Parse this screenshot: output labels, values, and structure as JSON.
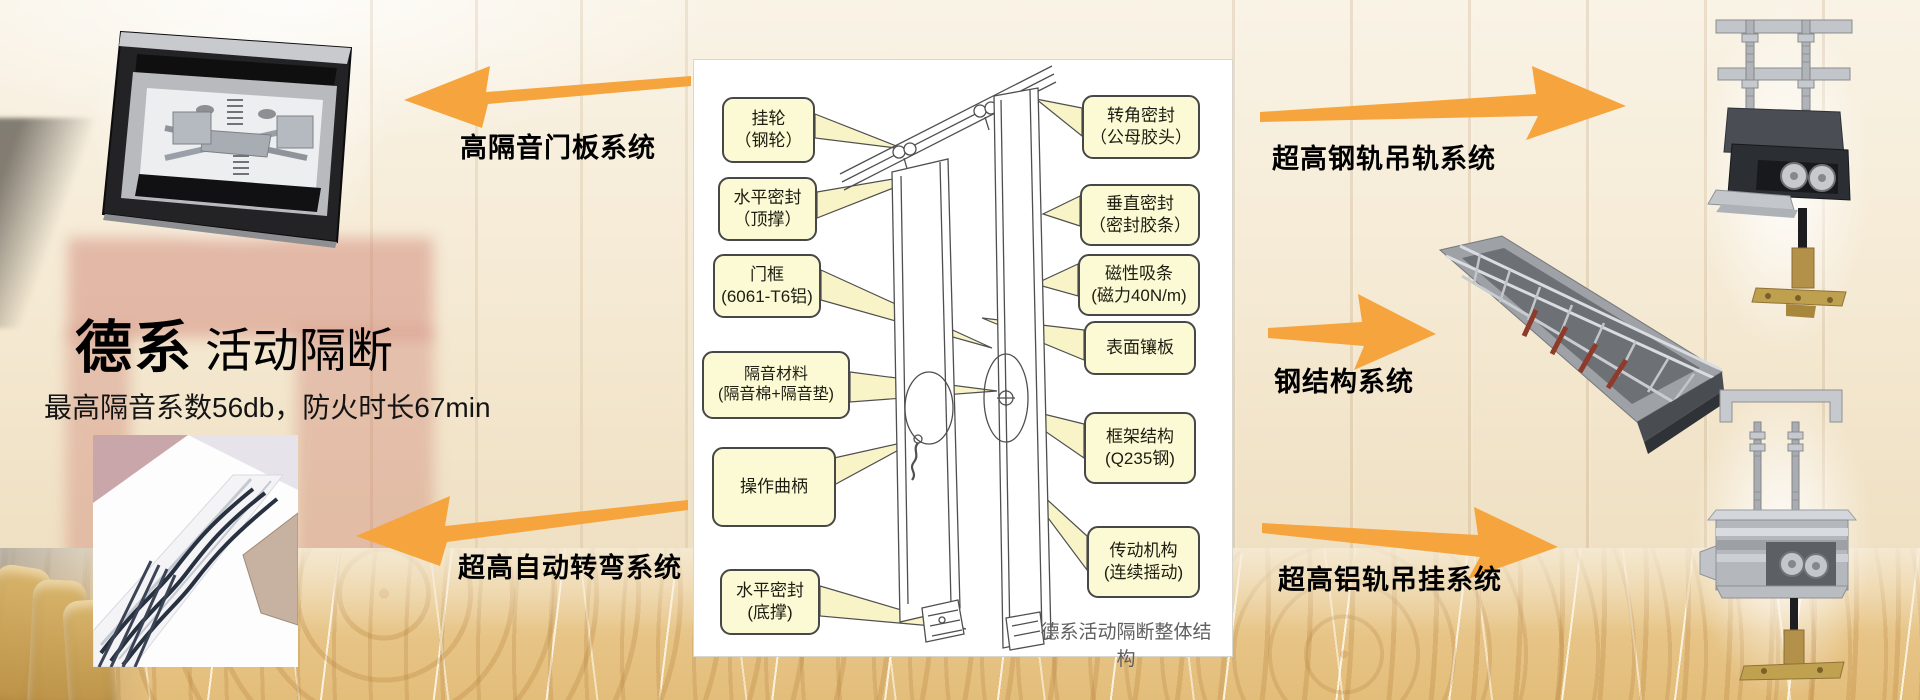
{
  "slide": {
    "title_bold": "德系",
    "title_light": "活动隔断",
    "subtitle": "最高隔音系数56db，防火时长67min"
  },
  "systems": {
    "left_top": "高隔音门板系统",
    "left_bottom": "超高自动转弯系统",
    "right_top": "超高钢轨吊轨系统",
    "right_mid": "钢结构系统",
    "right_bottom": "超高铝轨吊挂系统"
  },
  "diagram": {
    "caption": "德系活动隔断整体结构",
    "callouts_left": [
      {
        "line1": "挂轮",
        "line2": "（钢轮）"
      },
      {
        "line1": "水平密封",
        "line2": "（顶撑）"
      },
      {
        "line1": "门框",
        "line2": "(6061-T6铝)"
      },
      {
        "line1": "隔音材料",
        "line2": "(隔音棉+隔音垫)"
      },
      {
        "line1": "操作曲柄",
        "line2": ""
      },
      {
        "line1": "水平密封",
        "line2": "(底撑)"
      }
    ],
    "callouts_right": [
      {
        "line1": "转角密封",
        "line2": "（公母胶头）"
      },
      {
        "line1": "垂直密封",
        "line2": "（密封胶条）"
      },
      {
        "line1": "磁性吸条",
        "line2": "(磁力40N/m)"
      },
      {
        "line1": "表面镶板",
        "line2": ""
      },
      {
        "line1": "框架结构",
        "line2": "(Q235钢)"
      },
      {
        "line1": "传动机构",
        "line2": "(连续摇动)"
      }
    ]
  },
  "colors": {
    "arrow_orange": "#F6A53E",
    "callout_fill": "#FCFAD4",
    "callout_border": "#474747",
    "background_cream": "#F3E7D0"
  },
  "photos": {
    "top_left": "door-panel-internal-mechanism",
    "bottom_left": "curved-track-system",
    "top_right": "steel-rail-trolley-hardware",
    "mid_right": "steel-structure-frame",
    "bottom_right": "aluminum-rail-hanger-hardware"
  }
}
